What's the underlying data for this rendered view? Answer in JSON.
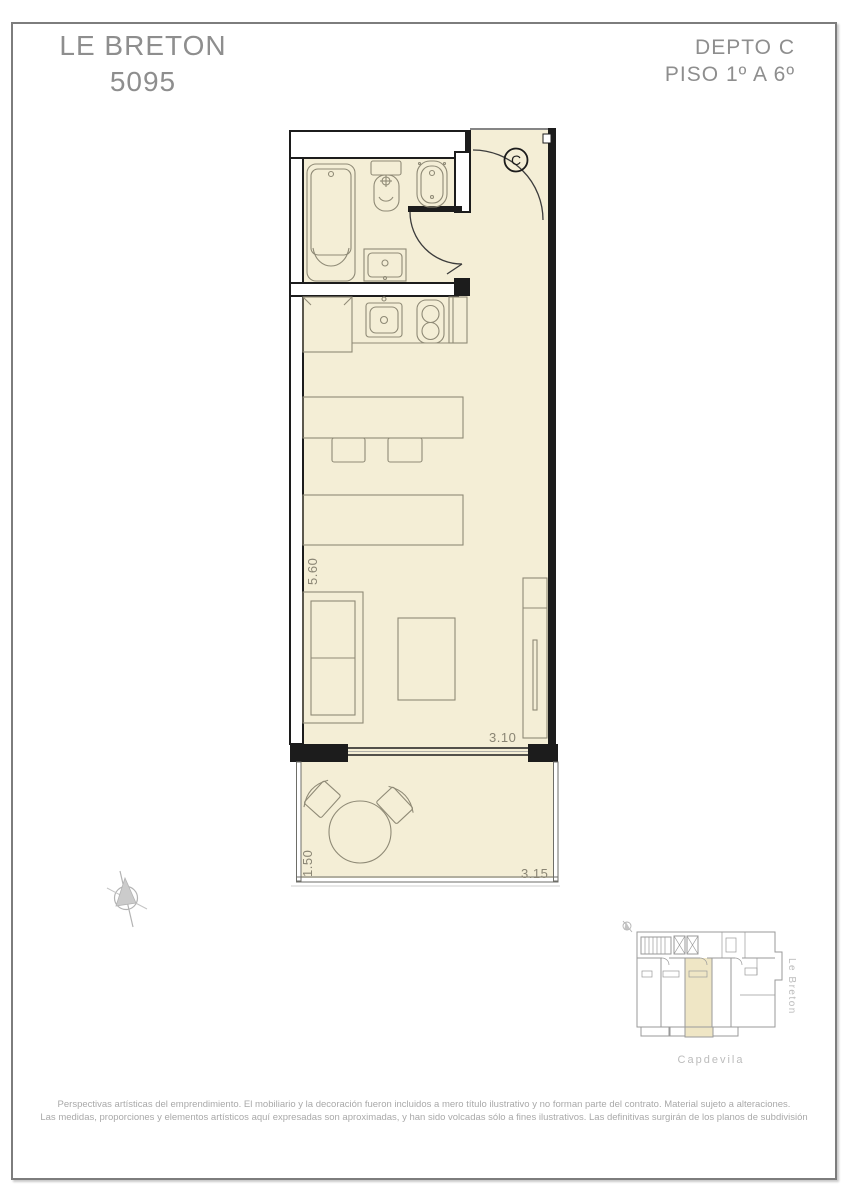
{
  "page": {
    "header": {
      "project_name": "LE BRETON",
      "project_number": "5095",
      "unit_label": "DEPTO C",
      "floor_label": "PISO 1º A 6º"
    },
    "plan": {
      "unit_circle_label": "C",
      "dimensions": {
        "living_depth": "5.60",
        "living_width": "3.10",
        "balcony_depth": "1.50",
        "balcony_width": "3.15"
      }
    },
    "key_plan": {
      "street_right": "Le Breton",
      "street_bottom": "Capdevila"
    },
    "disclaimer": {
      "line1": "Perspectivas artísticas del emprendimiento. El mobiliario y la decoración fueron incluidos a mero título ilustrativo y no forman parte del contrato. Material sujeto a alteraciones.",
      "line2": "Las medidas, proporciones y elementos artísticos aquí expresadas son aproximadas, y han sido volcadas sólo a fines ilustrativos. Las definitivas surgirán de los planos de subdivisión"
    },
    "colors": {
      "floor_fill": "#F4EED6",
      "wall": "#1C1C1C",
      "fixture_line": "#8F8A76",
      "header_text": "#8E8E8E",
      "dimension_text": "#8A8574",
      "keyplan_line": "#9A9A9A",
      "street_text": "#BCBCBC",
      "disclaimer_text": "#A9A9A9"
    }
  }
}
